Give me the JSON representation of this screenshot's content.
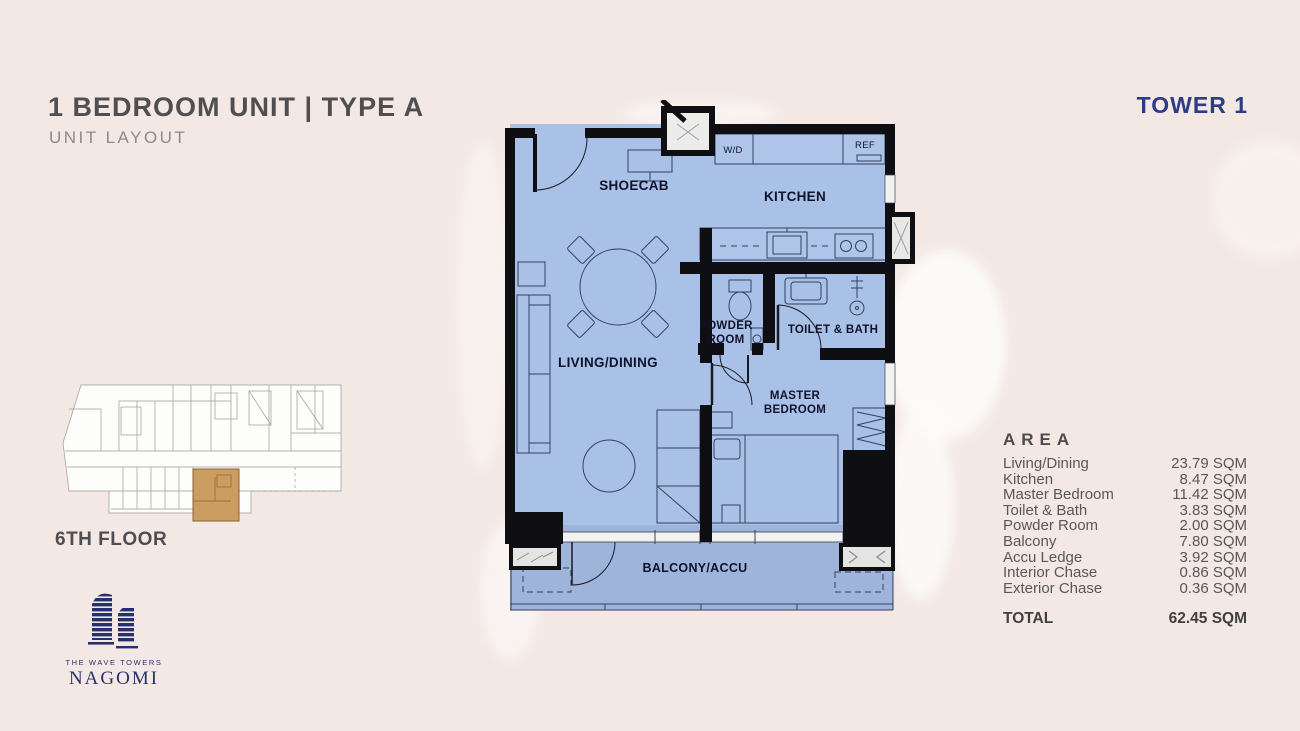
{
  "header": {
    "title": "1 BEDROOM UNIT | TYPE A",
    "subtitle": "UNIT LAYOUT",
    "tower": "TOWER 1"
  },
  "floor_plan": {
    "labels": {
      "shoecab": "SHOECAB",
      "kitchen": "KITCHEN",
      "washer_dryer": "W/D",
      "refrigerator": "REF",
      "powder_line1": "POWDER",
      "powder_line2": "ROOM",
      "toilet_bath": "TOILET & BATH",
      "living_dining": "LIVING/DINING",
      "master_line1": "MASTER",
      "master_line2": "BEDROOM",
      "balcony": "BALCONY/ACCU"
    }
  },
  "mini_map": {
    "floor_label": "6TH FLOOR"
  },
  "area_table": {
    "header": "AREA",
    "rows": [
      {
        "label": "Living/Dining",
        "value": "23.79 SQM"
      },
      {
        "label": "Kitchen",
        "value": "8.47 SQM"
      },
      {
        "label": "Master Bedroom",
        "value": "11.42 SQM"
      },
      {
        "label": "Toilet & Bath",
        "value": "3.83 SQM"
      },
      {
        "label": "Powder Room",
        "value": "2.00 SQM"
      },
      {
        "label": "Balcony",
        "value": "7.80 SQM"
      },
      {
        "label": "Accu Ledge",
        "value": "3.92 SQM"
      },
      {
        "label": "Interior Chase",
        "value": "0.86 SQM"
      },
      {
        "label": "Exterior Chase",
        "value": "0.36 SQM"
      }
    ],
    "total_label": "TOTAL",
    "total_value": "62.45 SQM"
  },
  "logo": {
    "tagline": "THE WAVE TOWERS",
    "brand": "NAGOMI"
  },
  "colors": {
    "accent_navy": "#2e3c85",
    "plan_fill": "#a9c1e7",
    "balcony_fill": "#9fb4da",
    "wall_black": "#0e0e13",
    "unit_highlight": "#cb9d60",
    "background": "#f3e8e4"
  }
}
